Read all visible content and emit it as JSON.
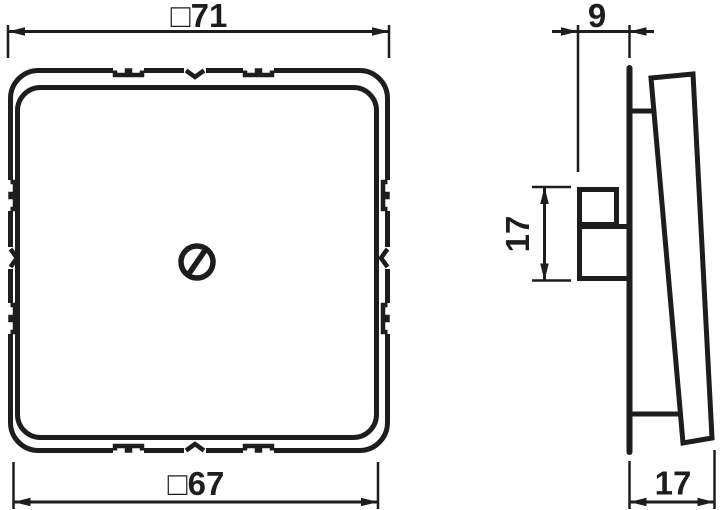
{
  "drawing": {
    "background_color": "#ffffff",
    "line_color": "#1d1d1b",
    "front_view": {
      "outer_width_label": "□71",
      "inner_width_label": "□67"
    },
    "side_view": {
      "front_depth_label": "9",
      "plug_height_label": "17",
      "total_depth_label": "17"
    }
  }
}
